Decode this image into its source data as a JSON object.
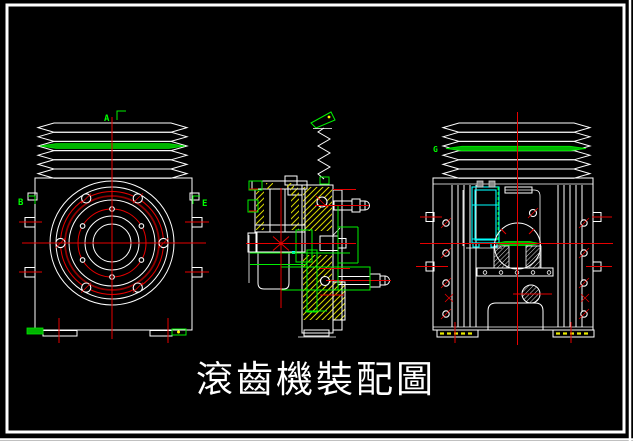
{
  "title": {
    "text": "滾齒機裝配圖"
  },
  "labels": {
    "a": "A",
    "b": "B",
    "e": "E",
    "g": "G"
  },
  "colors": {
    "background": "#000000",
    "outline": "#ffffff",
    "centerline_red": "#e80000",
    "dark_red_ring": "#8f0000",
    "annotation_green": "#00f000",
    "belt_green_fill": "#00b400",
    "hatch_yellow": "#d8d800",
    "fixture_cyan": "#00ffff",
    "dot_yellow": "#ffff00"
  }
}
